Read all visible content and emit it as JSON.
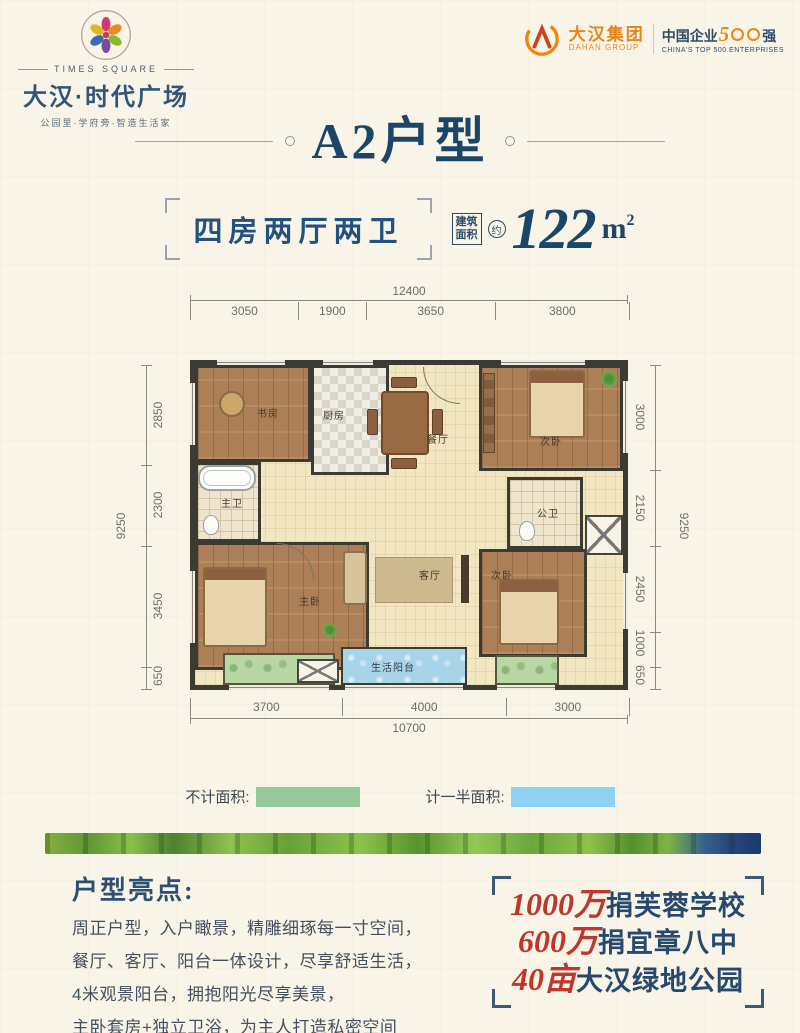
{
  "brand": {
    "times_square": "TIMES SQUARE",
    "name": "大汉·时代广场",
    "tagline": "公园里·学府旁·智造生活家"
  },
  "group": {
    "name": "大汉集团",
    "name_en": "DAHAN GROUP",
    "badge_prefix": "中国企业",
    "badge_five": "5",
    "badge_suffix": "强",
    "badge_en": "CHINA'S TOP 500 ENTERPRISES"
  },
  "title": "A2户型",
  "spec": {
    "layout": "四房两厅两卫",
    "area_label_1": "建筑",
    "area_label_2": "面积",
    "area_approx": "约",
    "area_value": "122",
    "area_unit": "m",
    "area_exp": "2"
  },
  "plan": {
    "rooms": {
      "study": "书房",
      "kitchen": "厨房",
      "dining": "餐厅",
      "bedroom_top": "次卧",
      "master_bath": "主卫",
      "public_bath": "公卫",
      "master_bedroom": "主卧",
      "living": "客厅",
      "bedroom_bottom": "次卧",
      "balcony": "生活阳台"
    },
    "dims": {
      "top_total": "12400",
      "top_segments": [
        "3050",
        "1900",
        "3650",
        "3800"
      ],
      "left_total": "9250",
      "left_segments": [
        "2850",
        "2300",
        "3450",
        "650"
      ],
      "right_total": "9250",
      "right_segments": [
        "3000",
        "2150",
        "2450",
        "1000",
        "650"
      ],
      "bottom_segments": [
        "3700",
        "4000",
        "3000"
      ],
      "bottom_total": "10700"
    }
  },
  "legend": {
    "no_area_label": "不计面积:",
    "half_area_label": "计一半面积:",
    "no_area_color": "#98c79a",
    "half_area_color": "#90d0f3"
  },
  "highlights": {
    "heading": "户型亮点:",
    "lines": [
      "周正户型，入户瞰景，精雕细琢每一寸空间，",
      "餐厅、客厅、阳台一体设计，尽享舒适生活，",
      "4米观景阳台，拥抱阳光尽享美景，",
      "主卧套房+独立卫浴，为主人打造私密空间"
    ]
  },
  "donations": [
    {
      "number": "1000万",
      "text": "捐芙蓉学校"
    },
    {
      "number": "600万",
      "text": "捐宜章八中"
    },
    {
      "number": "40亩",
      "text": "大汉绿地公园"
    }
  ],
  "colors": {
    "navy": "#1c4668",
    "red": "#bf372c",
    "orange": "#ee8612"
  }
}
